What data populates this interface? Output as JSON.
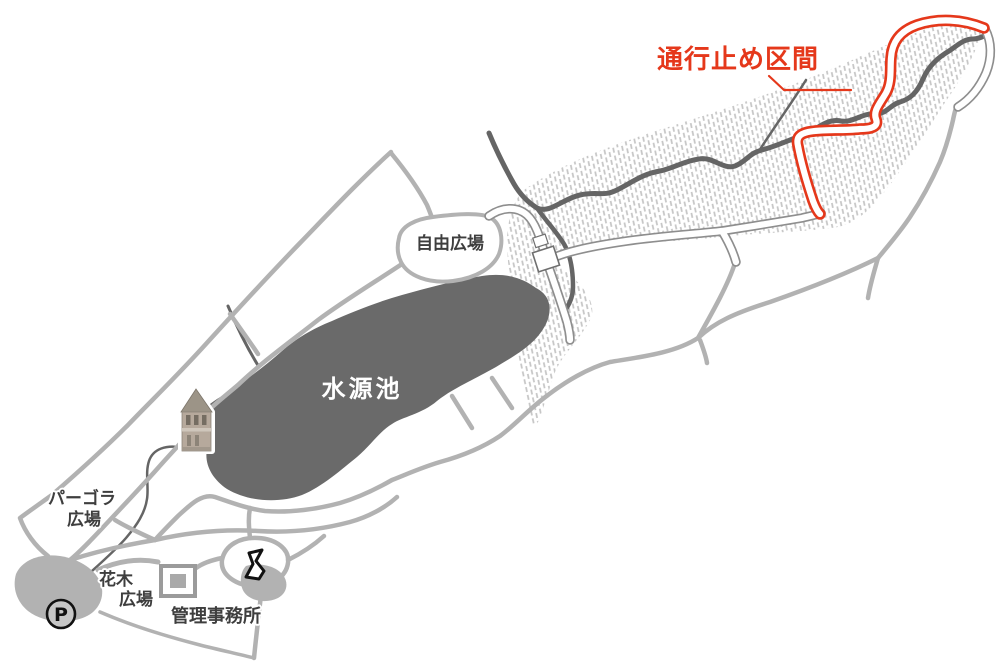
{
  "labels": {
    "closed_section": "通行止め区間",
    "free_plaza": "自由広場",
    "pond": "水源池",
    "pergola_plaza_line1": "パーゴラ",
    "pergola_plaza_line2": "広場",
    "flowering_plaza_line1": "花木",
    "flowering_plaza_line2": "広場",
    "management_office": "管理事務所",
    "parking": "P"
  },
  "colors": {
    "road-gray": "#b2b2b2",
    "pond-gray": "#6a6a6a",
    "stream-gray": "#656565",
    "hatch-gray": "#c5c5c5",
    "white-road-outline": "#8e8e8e",
    "closed-red": "#e5381b",
    "label-dark": "#3e3e3e",
    "tower-body": "#b6a99c",
    "tower-roof": "#9c9487",
    "icon-black": "#111111"
  }
}
